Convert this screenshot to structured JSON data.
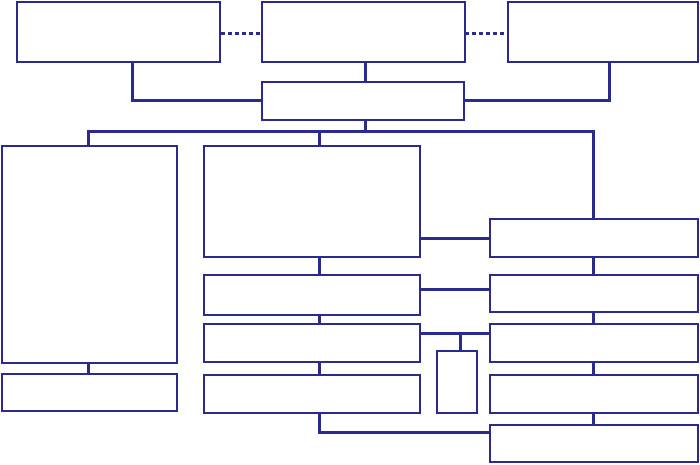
{
  "diagram": {
    "canvas": {
      "width": 700,
      "height": 465,
      "background": "#ffffff"
    },
    "style": {
      "stroke": "#2a2a8f",
      "box_fill": "#ffffff",
      "box_border_px": 2,
      "line_px": 3,
      "dash_on_px": 4,
      "dash_off_px": 3
    },
    "boxes": [
      {
        "name": "box-top-left",
        "x": 16,
        "y": 1,
        "w": 205,
        "h": 62
      },
      {
        "name": "box-top-center",
        "x": 261,
        "y": 1,
        "w": 205,
        "h": 62
      },
      {
        "name": "box-top-right",
        "x": 507,
        "y": 1,
        "w": 192,
        "h": 62
      },
      {
        "name": "box-hub",
        "x": 261,
        "y": 81,
        "w": 204,
        "h": 40
      },
      {
        "name": "box-left-tall",
        "x": 1,
        "y": 145,
        "w": 177,
        "h": 219
      },
      {
        "name": "box-left-bottom",
        "x": 1,
        "y": 373,
        "w": 177,
        "h": 39
      },
      {
        "name": "box-center-large",
        "x": 203,
        "y": 145,
        "w": 218,
        "h": 113
      },
      {
        "name": "box-center-2",
        "x": 203,
        "y": 274,
        "w": 218,
        "h": 42
      },
      {
        "name": "box-center-3",
        "x": 203,
        "y": 323,
        "w": 218,
        "h": 40
      },
      {
        "name": "box-center-4",
        "x": 203,
        "y": 374,
        "w": 218,
        "h": 40
      },
      {
        "name": "box-small-vertical",
        "x": 436,
        "y": 350,
        "w": 42,
        "h": 64
      },
      {
        "name": "box-right-1",
        "x": 489,
        "y": 218,
        "w": 210,
        "h": 40
      },
      {
        "name": "box-right-2",
        "x": 489,
        "y": 274,
        "w": 210,
        "h": 39
      },
      {
        "name": "box-right-3",
        "x": 489,
        "y": 323,
        "w": 210,
        "h": 40
      },
      {
        "name": "box-right-4",
        "x": 489,
        "y": 374,
        "w": 210,
        "h": 40
      },
      {
        "name": "box-right-5",
        "x": 489,
        "y": 424,
        "w": 210,
        "h": 39
      }
    ],
    "connectors": [
      {
        "name": "conn-dash-left",
        "x": 221,
        "y": 32,
        "w": 41,
        "h": 3,
        "line": "dashed"
      },
      {
        "name": "conn-dash-right",
        "x": 465,
        "y": 32,
        "w": 43,
        "h": 3,
        "line": "dashed"
      },
      {
        "name": "conn-topleft-down",
        "x": 131,
        "y": 61,
        "w": 3,
        "h": 41,
        "line": "solid"
      },
      {
        "name": "conn-topleft-elbow",
        "x": 131,
        "y": 99,
        "w": 133,
        "h": 3,
        "line": "solid"
      },
      {
        "name": "conn-topcenter-down",
        "x": 364,
        "y": 61,
        "w": 3,
        "h": 22,
        "line": "solid"
      },
      {
        "name": "conn-topright-down",
        "x": 608,
        "y": 61,
        "w": 3,
        "h": 41,
        "line": "solid"
      },
      {
        "name": "conn-topright-elbow",
        "x": 463,
        "y": 99,
        "w": 148,
        "h": 3,
        "line": "solid"
      },
      {
        "name": "conn-hub-down",
        "x": 364,
        "y": 119,
        "w": 3,
        "h": 13,
        "line": "solid"
      },
      {
        "name": "conn-trunk",
        "x": 87,
        "y": 130,
        "w": 508,
        "h": 3,
        "line": "solid"
      },
      {
        "name": "conn-trunk-left-down",
        "x": 87,
        "y": 130,
        "w": 3,
        "h": 17,
        "line": "solid"
      },
      {
        "name": "conn-trunk-center-down",
        "x": 318,
        "y": 130,
        "w": 3,
        "h": 17,
        "line": "solid"
      },
      {
        "name": "conn-trunk-right-down",
        "x": 592,
        "y": 130,
        "w": 3,
        "h": 90,
        "line": "solid"
      },
      {
        "name": "conn-lefttall-down",
        "x": 87,
        "y": 361,
        "w": 3,
        "h": 14,
        "line": "solid"
      },
      {
        "name": "conn-center1-right",
        "x": 419,
        "y": 237,
        "w": 72,
        "h": 3,
        "line": "solid"
      },
      {
        "name": "conn-center1-down",
        "x": 318,
        "y": 256,
        "w": 3,
        "h": 20,
        "line": "solid"
      },
      {
        "name": "conn-center2-right",
        "x": 419,
        "y": 288,
        "w": 72,
        "h": 3,
        "line": "solid"
      },
      {
        "name": "conn-center2-down",
        "x": 318,
        "y": 314,
        "w": 3,
        "h": 11,
        "line": "solid"
      },
      {
        "name": "conn-center3-right",
        "x": 419,
        "y": 332,
        "w": 72,
        "h": 3,
        "line": "solid"
      },
      {
        "name": "conn-smallbox-down",
        "x": 459,
        "y": 332,
        "w": 3,
        "h": 20,
        "line": "solid"
      },
      {
        "name": "conn-center3-down",
        "x": 318,
        "y": 361,
        "w": 3,
        "h": 15,
        "line": "solid"
      },
      {
        "name": "conn-center4-down",
        "x": 318,
        "y": 412,
        "w": 3,
        "h": 22,
        "line": "solid"
      },
      {
        "name": "conn-center4-elbow",
        "x": 318,
        "y": 431,
        "w": 173,
        "h": 3,
        "line": "solid"
      },
      {
        "name": "conn-right1-down",
        "x": 592,
        "y": 256,
        "w": 3,
        "h": 20,
        "line": "solid"
      },
      {
        "name": "conn-right2-down",
        "x": 592,
        "y": 311,
        "w": 3,
        "h": 14,
        "line": "solid"
      },
      {
        "name": "conn-right3-down",
        "x": 592,
        "y": 361,
        "w": 3,
        "h": 15,
        "line": "solid"
      },
      {
        "name": "conn-right4-down",
        "x": 592,
        "y": 412,
        "w": 3,
        "h": 14,
        "line": "solid"
      }
    ]
  }
}
